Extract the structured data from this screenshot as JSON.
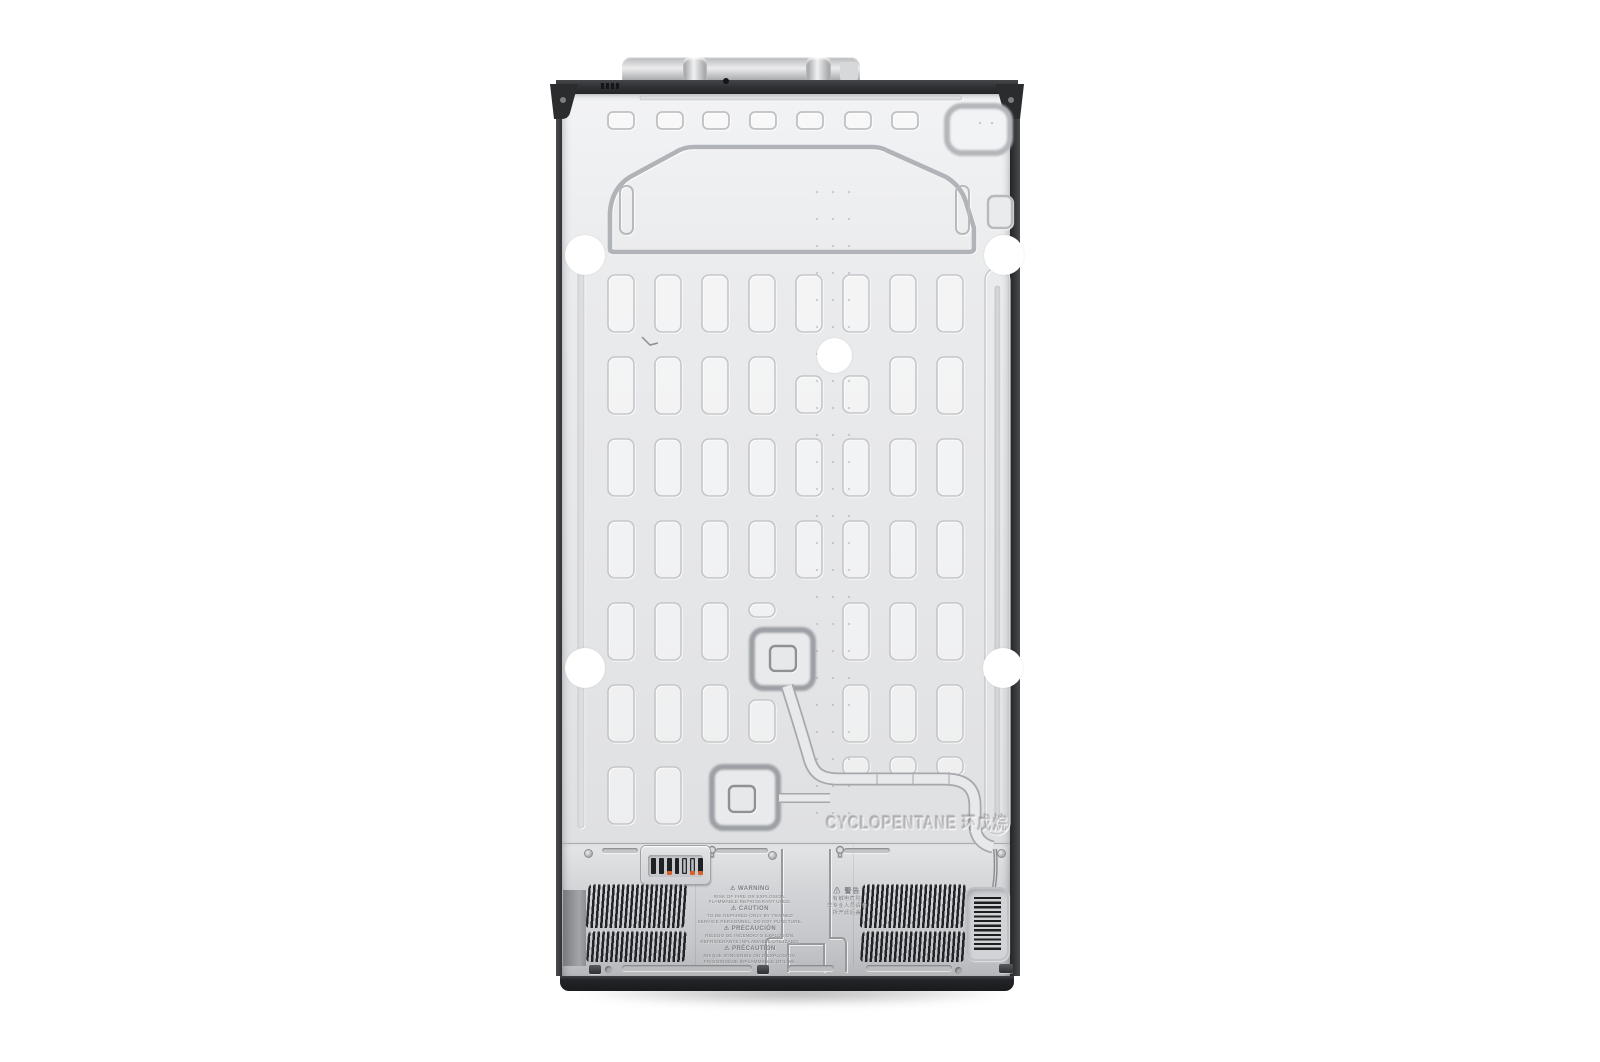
{
  "meta": {
    "description": "Rear view of a stainless refrigerator (product photo on white background)",
    "background_color": "#ffffff"
  },
  "back_panel": {
    "refrigerant_marking": {
      "en": "CYCLOPENTANE",
      "zh": "环戊烷"
    },
    "molded_numeral": "1"
  },
  "machine_compartment": {
    "caution_label": {
      "groups": [
        {
          "header": "⚠ WARNING",
          "lines": [
            "RISK OF FIRE OR EXPLOSION.",
            "FLAMMABLE REFRIGERANT USED."
          ]
        },
        {
          "header": "⚠ CAUTION",
          "lines": [
            "TO BE REPAIRED ONLY BY TRAINED",
            "SERVICE PERSONNEL. DO NOT PUNCTURE."
          ]
        },
        {
          "header": "⚠ PRECAUCIÓN",
          "lines": [
            "RIESGO DE INCENDIO O EXPLOSIÓN.",
            "REFRIGERANTE INFLAMABLE UTILIZADO."
          ]
        },
        {
          "header": "⚠ PRÉCAUTION",
          "lines": [
            "RISQUE D'INCENDIE OU D'EXPLOSION.",
            "FRIGORIGÈNE INFLAMMABLE UTILISÉ."
          ]
        }
      ]
    },
    "warning_label_zh": {
      "header": "⚠ 警告",
      "lines": [
        "有触电危险",
        "非专业人员请勿",
        "拆开此后盖"
      ]
    }
  },
  "colors": {
    "panel": "#e9eaec",
    "panel_light": "#f2f3f4",
    "compartment": "#c9cacd",
    "frame_dark": "#2b2c2e",
    "emboss_stroke": "#c3c5c9",
    "vent_slat": "#212225",
    "accent_orange": "#d4622a",
    "sticker_white": "#ffffff"
  }
}
